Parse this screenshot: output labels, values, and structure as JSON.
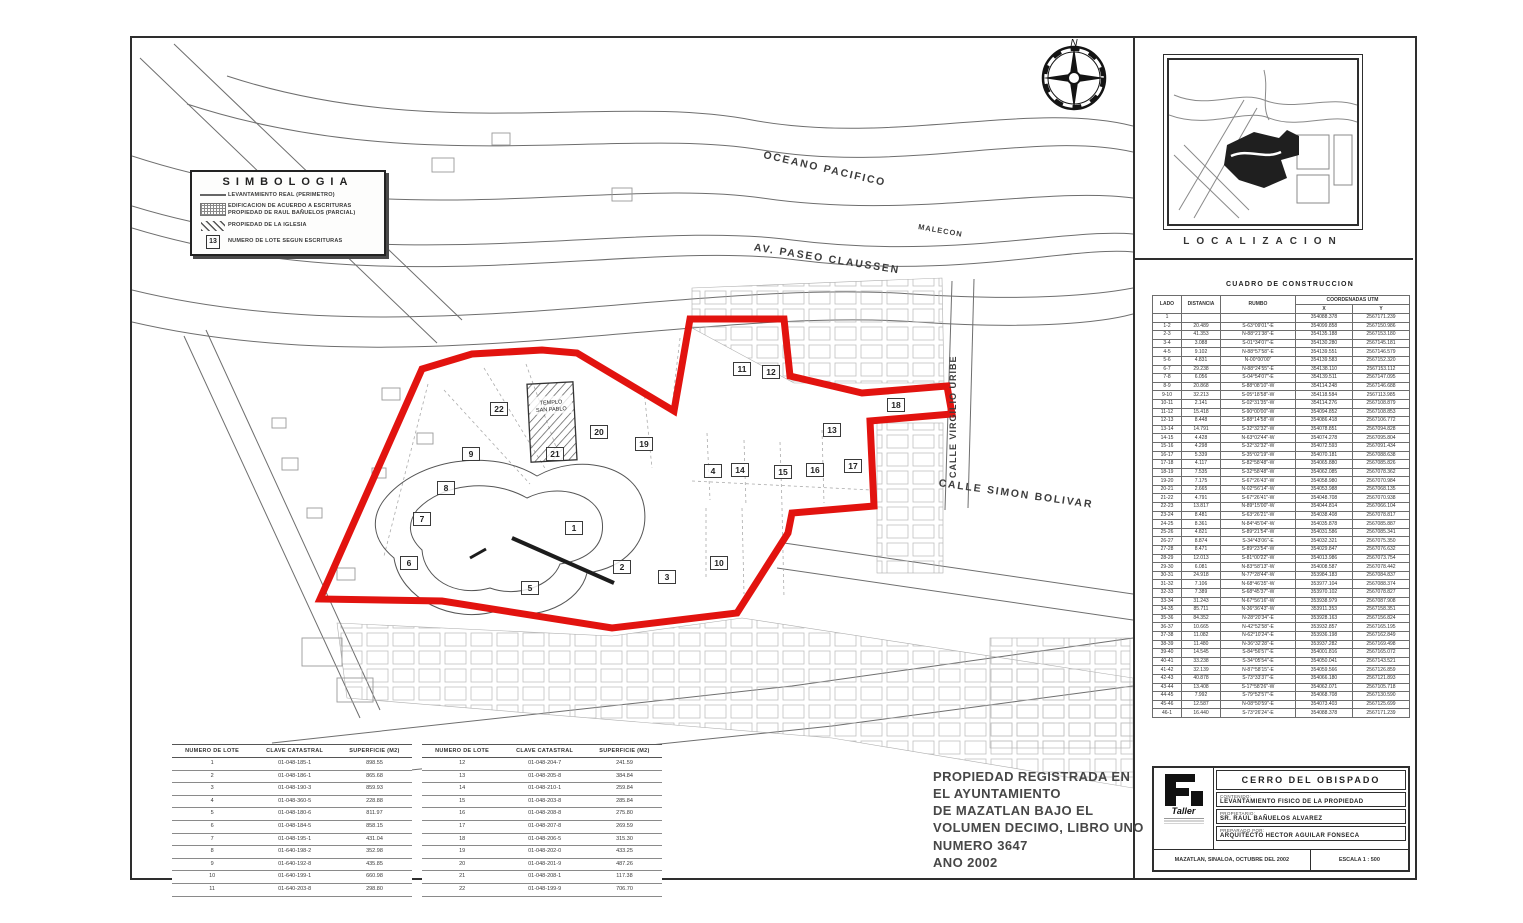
{
  "legend": {
    "title": "SIMBOLOGIA",
    "items": [
      {
        "label": "LEVANTAMIENTO REAL (PERIMETRO)"
      },
      {
        "label": "EDIFICACION DE ACUERDO A ESCRITURAS PROPIEDAD DE RAUL BAÑUELOS (PARCIAL)"
      },
      {
        "label": "PROPIEDAD DE LA IGLESIA"
      },
      {
        "label": "NUMERO DE LOTE SEGUN ESCRITURAS"
      }
    ],
    "lot_symbol_number": "13"
  },
  "compass": {
    "north": "N"
  },
  "streets": {
    "oceano": "OCEANO PACIFICO",
    "malecon": "MALECON",
    "claussen": "AV. PASEO CLAUSSEN",
    "virgilio": "CALLE VIRGILIO URIBE",
    "bolivar": "CALLE SIMON BOLIVAR"
  },
  "map": {
    "templo_line1": "TEMPLO",
    "templo_line2": "SAN PABLO",
    "lots": {
      "l1": "1",
      "l2": "2",
      "l3": "3",
      "l4": "4",
      "l5": "5",
      "l6": "6",
      "l7": "7",
      "l8": "8",
      "l9": "9",
      "l10": "10",
      "l11": "11",
      "l12": "12",
      "l13": "13",
      "l14": "14",
      "l15": "15",
      "l16": "16",
      "l17": "17",
      "l18": "18",
      "l19": "19",
      "l20": "20",
      "l21": "21",
      "l22": "22"
    }
  },
  "localizacion": {
    "label": "LOCALIZACION"
  },
  "cuadro": {
    "title": "CUADRO DE CONSTRUCCION",
    "col_lado": "LADO",
    "col_distancia": "DISTANCIA",
    "col_rumbo": "RUMBO",
    "col_coords": "COORDENADAS UTM",
    "col_x": "X",
    "col_y": "Y",
    "rows": [
      [
        "1",
        "",
        "",
        "354088.378",
        "2567171.239"
      ],
      [
        "1-2",
        "20.489",
        "S-63°09'01\"-E",
        "354099.858",
        "2567150.986"
      ],
      [
        "2-3",
        "41.353",
        "N-88°21'38\"-E",
        "354135.188",
        "2567153.180"
      ],
      [
        "3-4",
        "3.088",
        "S-01°34'07\"-E",
        "354130.280",
        "2567145.181"
      ],
      [
        "4-5",
        "9.102",
        "N-88°57'58\"-E",
        "354139.551",
        "2567146.579"
      ],
      [
        "5-6",
        "4.831",
        "N-00°00'00\"",
        "354139.583",
        "2567152.320"
      ],
      [
        "6-7",
        "29.238",
        "N-88°24'55\"-E",
        "354138.110",
        "2567153.112"
      ],
      [
        "7-8",
        "6.056",
        "S-04°54'07\"-E",
        "354139.511",
        "2567147.095"
      ],
      [
        "8-9",
        "20.868",
        "S-88°08'10\"-W",
        "354114.248",
        "2567146.688"
      ],
      [
        "9-10",
        "32.213",
        "S-05°18'58\"-W",
        "354118.584",
        "2567113.985"
      ],
      [
        "10-11",
        "2.141",
        "S-02°31'35\"-W",
        "354114.276",
        "2567108.879"
      ],
      [
        "11-12",
        "15.418",
        "S-90°00'00\"-W",
        "354094.852",
        "2567108.853"
      ],
      [
        "12-13",
        "8.448",
        "S-88°14'58\"-W",
        "354086.418",
        "2567106.772"
      ],
      [
        "13-14",
        "14.791",
        "S-32°32'32\"-W",
        "354078.851",
        "2567094.828"
      ],
      [
        "14-15",
        "4.428",
        "N-63°02'44\"-W",
        "354074.278",
        "2567095.804"
      ],
      [
        "15-16",
        "4.298",
        "S-32°32'32\"-W",
        "354072.593",
        "2567091.434"
      ],
      [
        "16-17",
        "5.339",
        "S-35°02'19\"-W",
        "354070.181",
        "2567088.638"
      ],
      [
        "17-18",
        "4.117",
        "S-82°58'48\"-W",
        "354065.880",
        "2567085.826"
      ],
      [
        "18-19",
        "7.535",
        "S-32°58'48\"-W",
        "354062.085",
        "2567078.362"
      ],
      [
        "19-20",
        "7.175",
        "S-67°26'43\"-W",
        "354058.980",
        "2567070.984"
      ],
      [
        "20-21",
        "2.665",
        "N-02°56'14\"-W",
        "354053.988",
        "2567068.135"
      ],
      [
        "21-22",
        "4.791",
        "S-67°26'41\"-W",
        "354048.708",
        "2567070.938"
      ],
      [
        "22-23",
        "13.817",
        "N-89°15'00\"-W",
        "354044.814",
        "2567066.104"
      ],
      [
        "23-24",
        "8.481",
        "S-63°26'21\"-W",
        "354038.408",
        "2567078.817"
      ],
      [
        "24-25",
        "8.361",
        "N-84°45'04\"-W",
        "354035.878",
        "2567085.887"
      ],
      [
        "25-26",
        "4.821",
        "S-89°21'54\"-W",
        "354031.586",
        "2567085.341"
      ],
      [
        "26-27",
        "8.874",
        "S-34°43'06\"-E",
        "354032.321",
        "2567075.350"
      ],
      [
        "27-28",
        "8.471",
        "S-89°23'54\"-W",
        "354029.847",
        "2567076.632"
      ],
      [
        "28-29",
        "12.013",
        "S-81°00'22\"-W",
        "354013.986",
        "2567073.754"
      ],
      [
        "29-30",
        "6.081",
        "N-83°58'13\"-W",
        "354008.587",
        "2567078.442"
      ],
      [
        "30-31",
        "24.918",
        "N-77°28'44\"-W",
        "353984.183",
        "2567084.837"
      ],
      [
        "31-32",
        "7.106",
        "N-68°46'35\"-W",
        "353977.104",
        "2567088.374"
      ],
      [
        "32-33",
        "7.389",
        "S-68°45'37\"-W",
        "353970.102",
        "2567078.827"
      ],
      [
        "33-34",
        "31.243",
        "N-67°56'16\"-W",
        "353938.979",
        "2567087.908"
      ],
      [
        "34-35",
        "85.711",
        "N-36°36'43\"-W",
        "353911.353",
        "2567158.351"
      ],
      [
        "35-36",
        "84.352",
        "N-28°20'34\"-E",
        "353928.163",
        "2567156.824"
      ],
      [
        "36-37",
        "10.665",
        "N-42°52'58\"-E",
        "353932.857",
        "2567165.195"
      ],
      [
        "37-38",
        "11.082",
        "N-62°10'24\"-E",
        "353936.198",
        "2567162.849"
      ],
      [
        "38-39",
        "11.480",
        "N-36°32'28\"-E",
        "353937.282",
        "2567169.498"
      ],
      [
        "39-40",
        "14.545",
        "S-84°56'57\"-E",
        "354001.816",
        "2567165.072"
      ],
      [
        "40-41",
        "33.238",
        "S-34°05'54\"-E",
        "354050.041",
        "2567143.521"
      ],
      [
        "41-42",
        "32.139",
        "N-87°58'15\"-E",
        "354059.566",
        "2567126.859"
      ],
      [
        "42-43",
        "40.878",
        "S-73°33'37\"-E",
        "354066.180",
        "2567121.893"
      ],
      [
        "43-44",
        "13.408",
        "S-17°58'26\"-W",
        "354062.071",
        "2567105.718"
      ],
      [
        "44-45",
        "7.992",
        "S-79°52'57\"-E",
        "354068.708",
        "2567130.590"
      ],
      [
        "45-46",
        "12.587",
        "N-08°50'59\"-E",
        "354073.403",
        "2567125.699"
      ],
      [
        "46-1",
        "16.440",
        "S-73°26'24\"-E",
        "354088.378",
        "2567171.239"
      ]
    ]
  },
  "lot_tables": {
    "col_lote": "NUMERO DE LOTE",
    "col_clave": "CLAVE CATASTRAL",
    "col_superficie": "SUPERFICIE (M2)",
    "table_a": [
      [
        "1",
        "01-048-185-1",
        "898.55"
      ],
      [
        "2",
        "01-048-186-1",
        "865.68"
      ],
      [
        "3",
        "01-048-190-3",
        "859.93"
      ],
      [
        "4",
        "01-048-360-5",
        "228.88"
      ],
      [
        "5",
        "01-048-180-6",
        "811.97"
      ],
      [
        "6",
        "01-048-184-5",
        "858.15"
      ],
      [
        "7",
        "01-048-195-1",
        "431.04"
      ],
      [
        "8",
        "01-640-198-2",
        "352.98"
      ],
      [
        "9",
        "01-640-192-8",
        "435.85"
      ],
      [
        "10",
        "01-640-199-1",
        "660.98"
      ],
      [
        "11",
        "01-640-203-8",
        "298.80"
      ]
    ],
    "table_b": [
      [
        "12",
        "01-048-204-7",
        "241.59"
      ],
      [
        "13",
        "01-048-205-8",
        "384.84"
      ],
      [
        "14",
        "01-048-210-1",
        "259.84"
      ],
      [
        "15",
        "01-048-203-8",
        "285.84"
      ],
      [
        "16",
        "01-048-208-8",
        "275.80"
      ],
      [
        "17",
        "01-048-207-8",
        "269.59"
      ],
      [
        "18",
        "01-048-206-5",
        "315.30"
      ],
      [
        "19",
        "01-048-202-0",
        "433.25"
      ],
      [
        "20",
        "01-048-201-9",
        "487.26"
      ],
      [
        "21",
        "01-048-208-1",
        "117.38"
      ],
      [
        "22",
        "01-048-199-9",
        "706.70"
      ]
    ]
  },
  "registry": {
    "line1": "PROPIEDAD REGISTRADA EN",
    "line2": "EL AYUNTAMIENTO",
    "line3": "DE MAZATLAN BAJO EL",
    "line4": "VOLUMEN DECIMO, LIBRO UNO",
    "line5": "NUMERO  3647",
    "line6": "ANO 2002"
  },
  "title_block": {
    "project": "CERRO DEL OBISPADO",
    "contenido_label": "CONTENIDO:",
    "contenido": "LEVANTAMIENTO FISICO DE LA PROPIEDAD",
    "propietario_label": "PROPIETARIO:",
    "propietario": "SR. RAUL BAÑUELOS ALVAREZ",
    "preparado_label": "PREPARADO POR:",
    "preparado": "ARQUITECTO HECTOR AGUILAR FONSECA",
    "lugar_fecha": "MAZATLAN, SINALOA, OCTUBRE DEL 2002",
    "escala": "ESCALA 1 : 500",
    "logo_text": "Taller"
  },
  "colors": {
    "boundary_red": "#e2130f"
  }
}
